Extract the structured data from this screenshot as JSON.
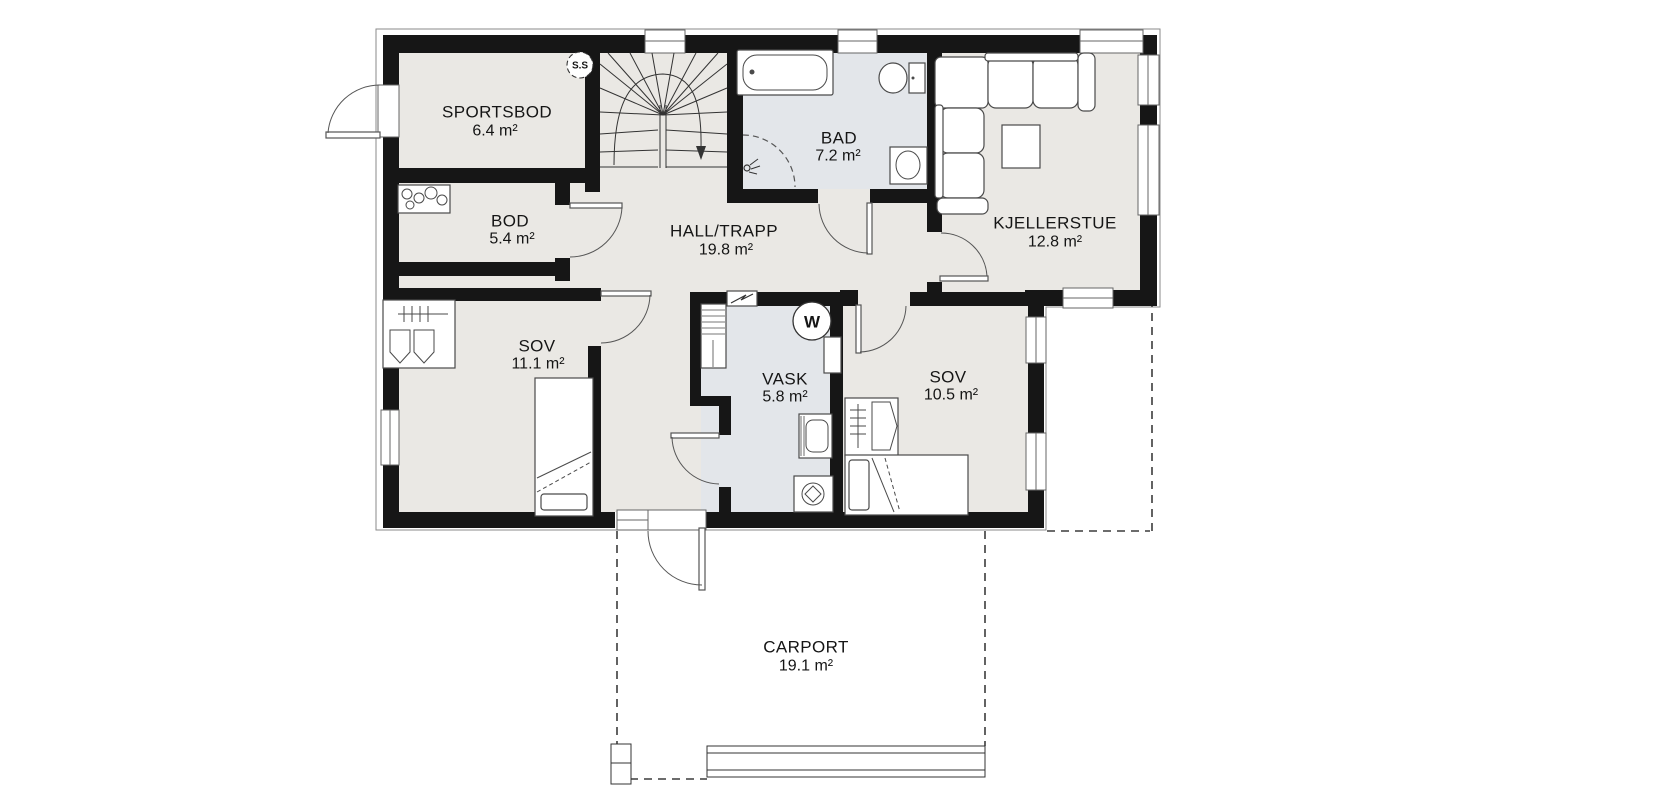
{
  "plan": {
    "title": "basement-floor-plan",
    "rooms": [
      {
        "name": "SPORTSBOD",
        "area": "6.4 m²",
        "area_m2": 6.4
      },
      {
        "name": "BOD",
        "area": "5.4 m²",
        "area_m2": 5.4
      },
      {
        "name": "HALL/TRAPP",
        "area": "19.8 m²",
        "area_m2": 19.8
      },
      {
        "name": "BAD",
        "area": "7.2 m²",
        "area_m2": 7.2
      },
      {
        "name": "KJELLERSTUE",
        "area": "12.8 m²",
        "area_m2": 12.8
      },
      {
        "name": "SOV",
        "area": "11.1 m²",
        "area_m2": 11.1
      },
      {
        "name": "VASK",
        "area": "5.8 m²",
        "area_m2": 5.8
      },
      {
        "name": "SOV",
        "area": "10.5 m²",
        "area_m2": 10.5
      },
      {
        "name": "CARPORT",
        "area": "19.1 m²",
        "area_m2": 19.1
      }
    ],
    "markers": {
      "fuse_box": "S.S",
      "water_heater": "W"
    },
    "colors": {
      "wall": "#161616",
      "floor": "#eae8e4",
      "wet_floor": "#e3e6ea",
      "outline": "#8a8a8a"
    }
  }
}
